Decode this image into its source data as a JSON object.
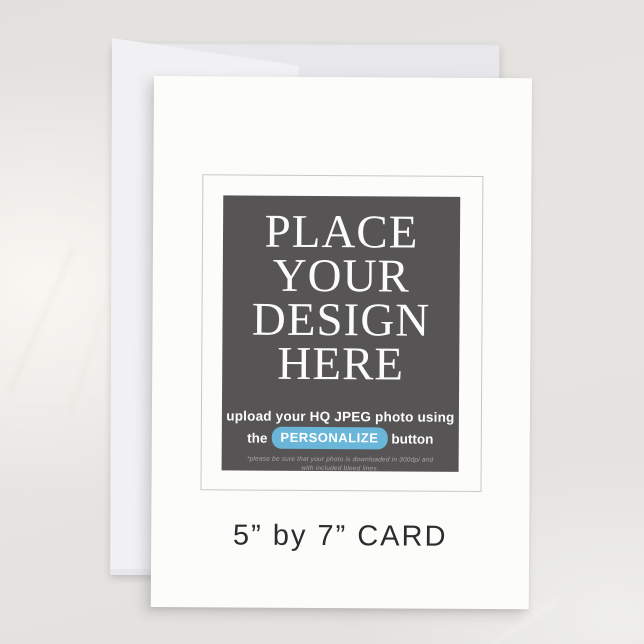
{
  "product": {
    "caption": "5” by 7” CARD"
  },
  "placeholder": {
    "design_lines": [
      "PLACE",
      "YOUR",
      "DESIGN",
      "HERE"
    ],
    "upload_line": "upload your HQ JPEG photo using",
    "button_prefix": "the",
    "button_label": "PERSONALIZE",
    "button_suffix": "button",
    "note_line1": "*please be sure that your photo is downloaded in 300dpi and",
    "note_line2": "with included bleed lines."
  },
  "colors": {
    "background_marble": "#e4e2df",
    "back_card_panel": "#e8e8ec",
    "back_card_flap": "#f1f1f4",
    "front_card": "#fcfcfb",
    "frame_border": "#c9c8c8",
    "placeholder_box": "#575455",
    "placeholder_text": "#fbfbfb",
    "personalize_pill": "#69b6d8",
    "note_text": "#a9a7a8",
    "caption_text": "#2d2c2d"
  }
}
